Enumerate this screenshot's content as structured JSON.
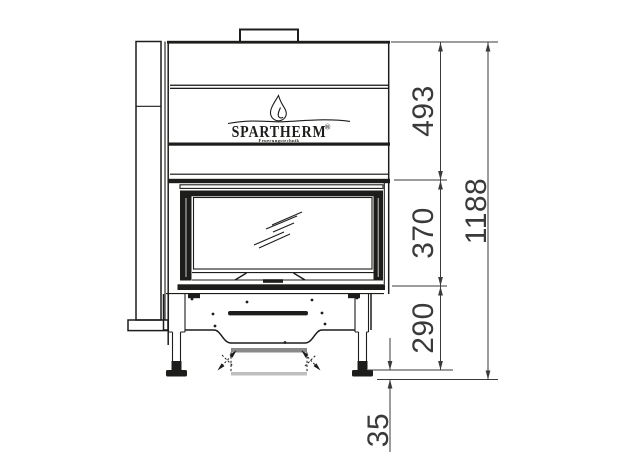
{
  "logo": {
    "brand": "SPARTHERM",
    "registered": "®",
    "tagline": "Feuerungstechnik"
  },
  "dimensions": {
    "upper_section": "493",
    "window_section": "370",
    "base_section": "290",
    "total_height": "1188",
    "foot_adjust": "35"
  },
  "colors": {
    "line": "#1d1d1b",
    "dimension": "#3a3a3a",
    "stipple": "#8a8a8a",
    "background": "#ffffff"
  }
}
